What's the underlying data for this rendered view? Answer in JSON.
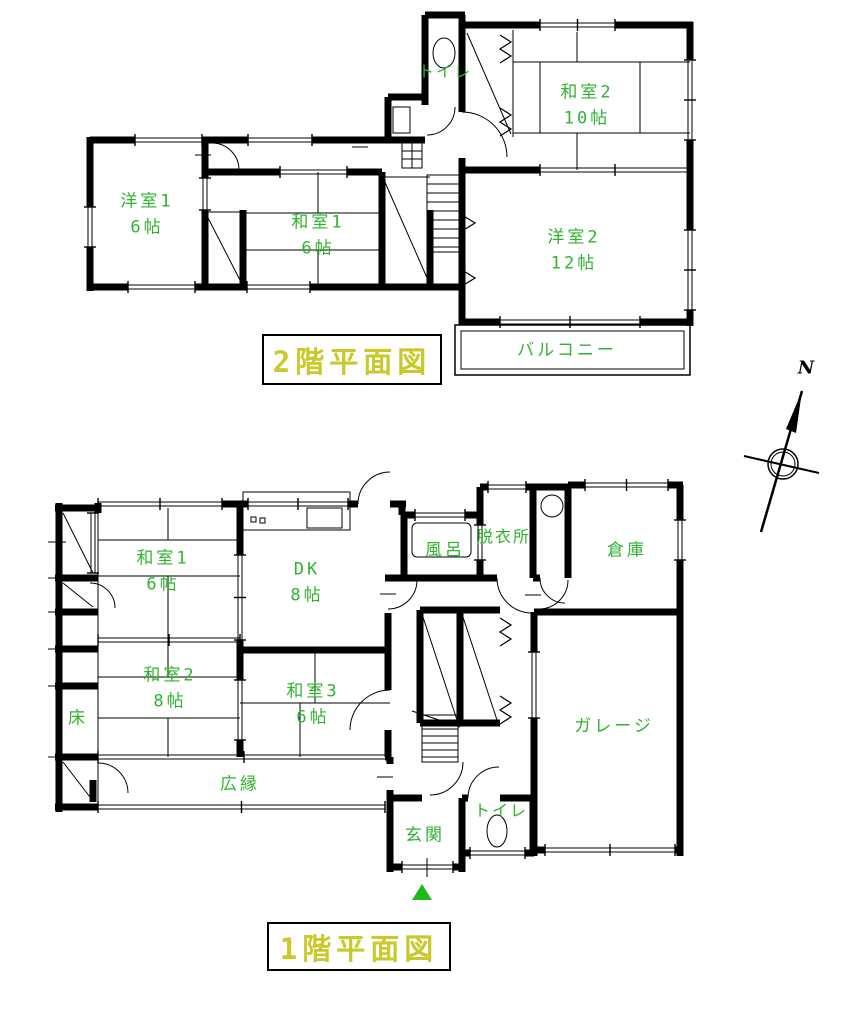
{
  "document": {
    "kind": "floor-plan"
  },
  "colors": {
    "label_green": "#2fb32f",
    "title_yellow": "#c9c92b",
    "wall_black": "#000000",
    "entrance_marker_green": "#1db91d"
  },
  "compass": {
    "label": "N"
  },
  "floor2": {
    "title": "2階平面図",
    "rooms": [
      {
        "name": "トイレ",
        "size": ""
      },
      {
        "name": "和室2",
        "size": "10帖"
      },
      {
        "name": "洋室1",
        "size": "6帖"
      },
      {
        "name": "和室1",
        "size": "6帖"
      },
      {
        "name": "洋室2",
        "size": "12帖"
      },
      {
        "name": "バルコニー",
        "size": ""
      }
    ]
  },
  "floor1": {
    "title": "1階平面図",
    "rooms": [
      {
        "name": "和室1",
        "size": "6帖"
      },
      {
        "name": "DK",
        "size": "8帖"
      },
      {
        "name": "風呂",
        "size": ""
      },
      {
        "name": "脱衣所",
        "size": ""
      },
      {
        "name": "倉庫",
        "size": ""
      },
      {
        "name": "和室2",
        "size": "8帖"
      },
      {
        "name": "和室3",
        "size": "6帖"
      },
      {
        "name": "床",
        "size": ""
      },
      {
        "name": "広縁",
        "size": ""
      },
      {
        "name": "玄関",
        "size": ""
      },
      {
        "name": "トイレ",
        "size": ""
      },
      {
        "name": "ガレージ",
        "size": ""
      }
    ]
  }
}
